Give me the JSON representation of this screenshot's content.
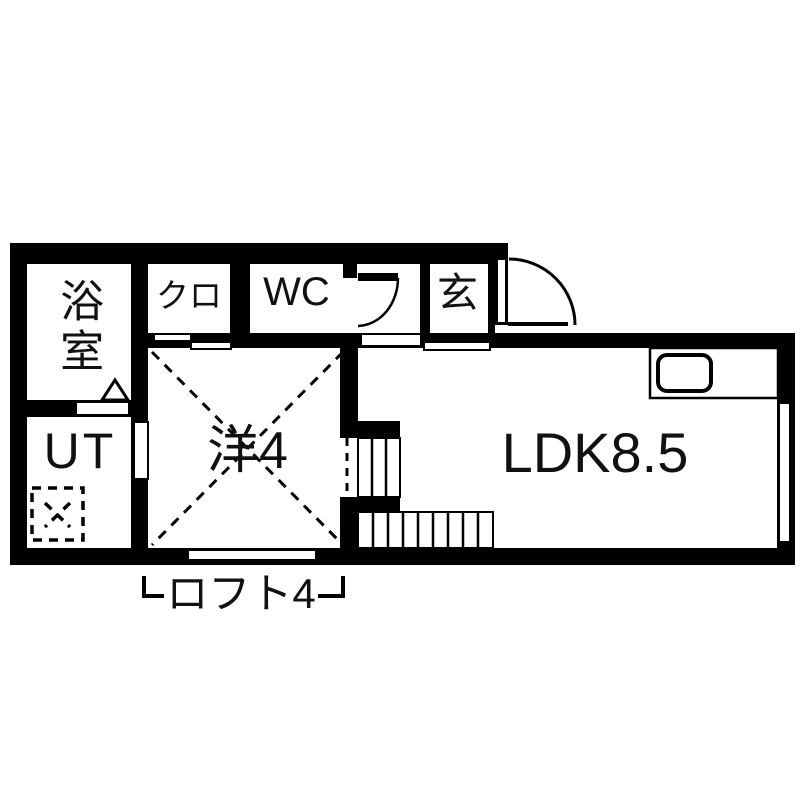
{
  "plan_title": "apartment-floor-plan",
  "rooms": {
    "bath": {
      "label": "浴室"
    },
    "closet": {
      "label": "クロ"
    },
    "toilet": {
      "label": "WC"
    },
    "entrance": {
      "label": "玄"
    },
    "utility": {
      "label": "UT"
    },
    "western_room": {
      "label": "洋4"
    },
    "ldk": {
      "label": "LDK8.5"
    },
    "loft": {
      "label": "ロフト4"
    }
  },
  "colors": {
    "wall": "#000000",
    "floor": "#ffffff",
    "ink": "#111111"
  }
}
